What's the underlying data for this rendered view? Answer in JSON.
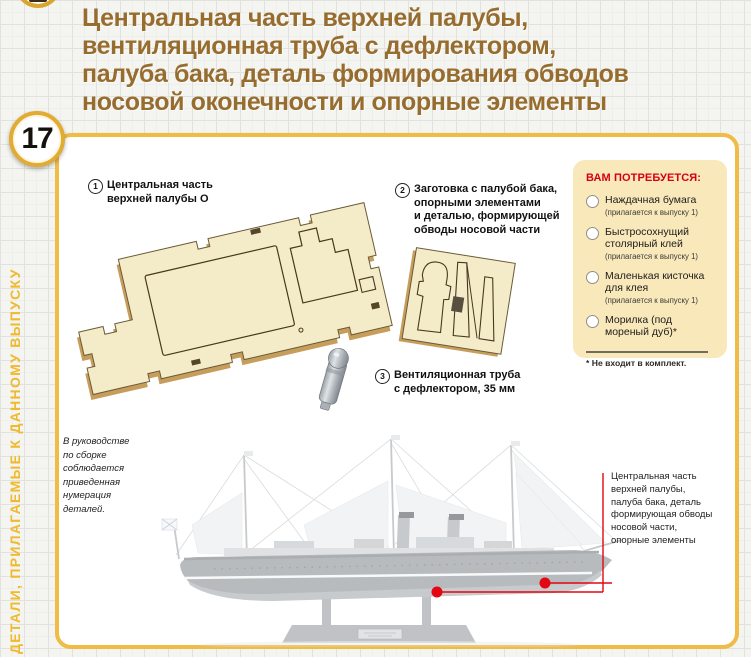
{
  "page": {
    "issue_number": "17",
    "sidebar_label": "ДЕТАЛИ, ПРИЛАГАЕМЫЕ К ДАННОМУ ВЫПУСКУ"
  },
  "title": {
    "lines": [
      "Центральная часть верхней палубы,",
      "вентиляционная труба с дефлектором,",
      "палуба бака, деталь формирования обводов",
      "носовой оконечности и опорные элементы"
    ]
  },
  "parts": {
    "part1": {
      "num": "1",
      "lines": [
        "Центральная часть",
        "верхней палубы О"
      ]
    },
    "part2": {
      "num": "2",
      "lines": [
        "Заготовка с палубой бака,",
        "опорными элементами",
        "и деталью, формирующей",
        "обводы носовой части"
      ]
    },
    "part3": {
      "num": "3",
      "lines": [
        "Вентиляционная труба",
        "с дефлектором, 35 мм"
      ]
    }
  },
  "needs": {
    "header": "ВАМ ПОТРЕБУЕТСЯ:",
    "items": [
      {
        "name": "Наждачная бумага",
        "note": "(прилагается к выпуску 1)"
      },
      {
        "name": "Быстросохнущий столярный клей",
        "note": "(прилагается к выпуску 1)"
      },
      {
        "name": "Маленькая кисточка для клея",
        "note": "(прилагается к выпуску 1)"
      },
      {
        "name": "Морилка (под мореный дуб)*",
        "note": ""
      }
    ],
    "footnote": "* Не входит в комплект."
  },
  "assembly_note": {
    "lines": [
      "В руководстве",
      "по сборке",
      "соблюдается",
      "приведенная",
      "нумерация",
      "деталей."
    ]
  },
  "ship_callout": {
    "lines": [
      "Центральная часть",
      "верхней палубы,",
      "палуба бака, деталь",
      "формирующая обводы",
      "носовой части,",
      "опорные элементы"
    ]
  },
  "colors": {
    "accent_gold": "#efba2e",
    "panel_border": "#f0bc45",
    "title_brown": "#976d2f",
    "needs_bg": "#f9e8ba",
    "needs_red": "#d50011",
    "callout_red": "#e30613",
    "wood": "#f4ecc8",
    "wood_edge": "#c79d5c"
  }
}
